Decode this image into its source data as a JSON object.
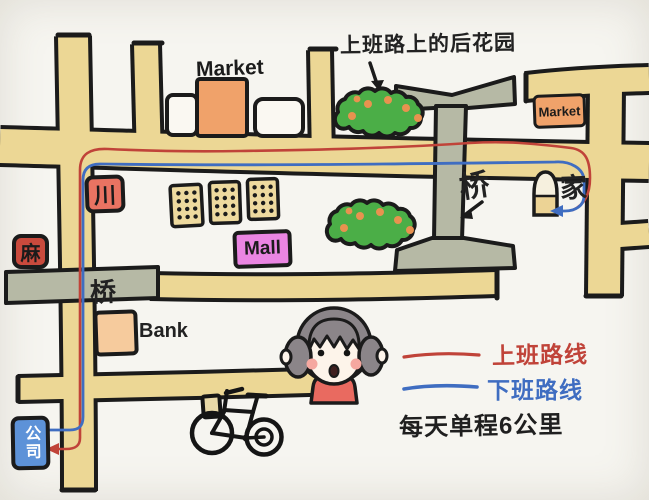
{
  "annotations": {
    "garden_note": "上班路上的后花园",
    "distance_note": "每天单程6公里"
  },
  "places": {
    "market_top": "Market",
    "market_right": "Market",
    "mall": "Mall",
    "bank": "Bank",
    "sichuan_sign": "川",
    "ma_sign": "麻",
    "bridge_left": "桥",
    "bridge_right": "桥",
    "home": "家",
    "company": "公司"
  },
  "legend": {
    "to_work": {
      "label": "上班路线",
      "color": "#c04339"
    },
    "off_work": {
      "label": "下班路线",
      "color": "#3f6dc1"
    }
  },
  "colors": {
    "outline": "#1b1b1b",
    "road": "#ecd795",
    "bridge": "#b6b9a5",
    "bush": "#4bae47",
    "bush_flower": "#e8924f",
    "market": "#f0a26a",
    "mall": "#ea85e2",
    "bank": "#f6cb9d",
    "company": "#5d92d8",
    "sichuan_sign": "#e97362",
    "ma_sign": "#c94a3d"
  }
}
